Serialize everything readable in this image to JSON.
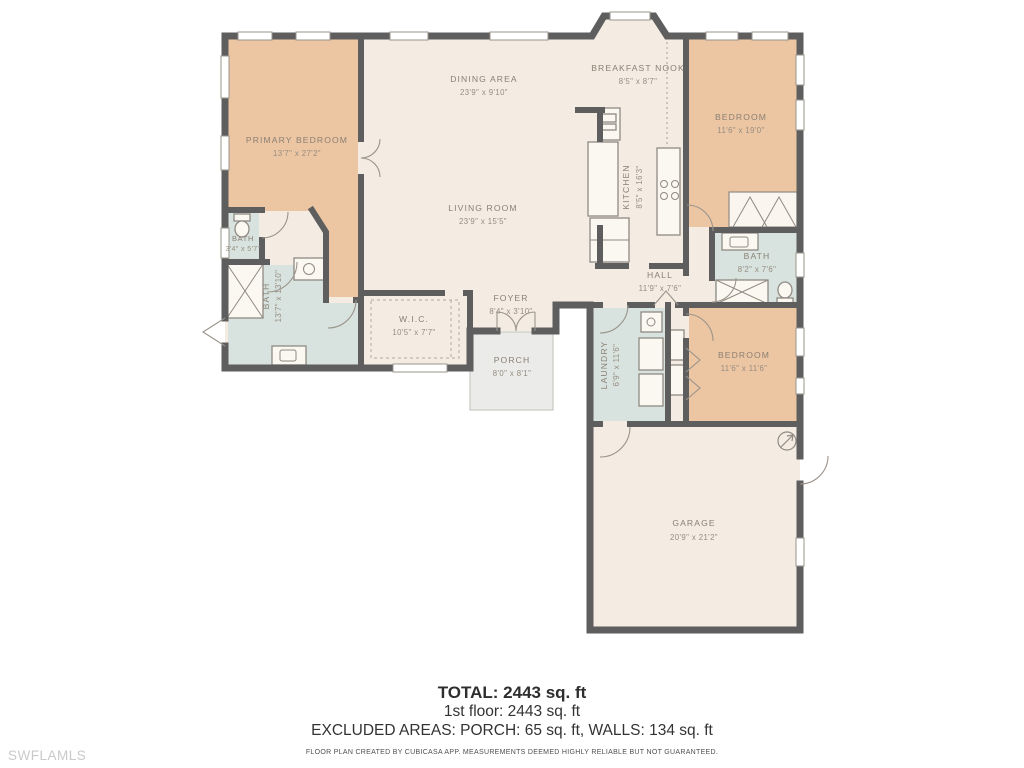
{
  "watermark": "SWFLAMLS",
  "colors": {
    "wall": "#5e5e5e",
    "room_warm": "#ecc5a3",
    "room_neutral": "#f4ebe3",
    "room_wet": "#d8e3e0",
    "porch": "#ebebe9",
    "label_text": "#8a8073"
  },
  "rooms": [
    {
      "name": "PRIMARY BEDROOM",
      "dims": "13'7\" x 27'2\""
    },
    {
      "name": "DINING AREA",
      "dims": "23'9\" x 9'10\""
    },
    {
      "name": "BREAKFAST NOOK",
      "dims": "8'5\" x 8'7\""
    },
    {
      "name": "LIVING ROOM",
      "dims": "23'9\" x 15'5\""
    },
    {
      "name": "KITCHEN",
      "dims": "8'5\" x 16'3\""
    },
    {
      "name": "BEDROOM",
      "dims": "11'6\" x 19'0\""
    },
    {
      "name": "BATH",
      "dims": "3'4\" x 5'7\""
    },
    {
      "name": "BATH",
      "dims": "13'7\" x 13'10\""
    },
    {
      "name": "W.I.C.",
      "dims": "10'5\" x 7'7\""
    },
    {
      "name": "FOYER",
      "dims": "8'4\" x 3'10\""
    },
    {
      "name": "PORCH",
      "dims": "8'0\" x 8'1\""
    },
    {
      "name": "HALL",
      "dims": "11'9\" x 7'6\""
    },
    {
      "name": "BATH",
      "dims": "8'2\" x 7'6\""
    },
    {
      "name": "LAUNDRY",
      "dims": "6'9\" x 11'6\""
    },
    {
      "name": "BEDROOM",
      "dims": "11'6\" x 11'6\""
    },
    {
      "name": "GARAGE",
      "dims": "20'9\" x 21'2\""
    }
  ],
  "summary": {
    "total": "TOTAL: 2443 sq. ft",
    "first_floor": "1st floor: 2443 sq. ft",
    "excluded": "EXCLUDED AREAS: PORCH: 65 sq. ft, WALLS: 134 sq. ft",
    "disclaimer": "FLOOR PLAN CREATED BY CUBICASA APP. MEASUREMENTS DEEMED HIGHLY RELIABLE BUT NOT GUARANTEED."
  }
}
